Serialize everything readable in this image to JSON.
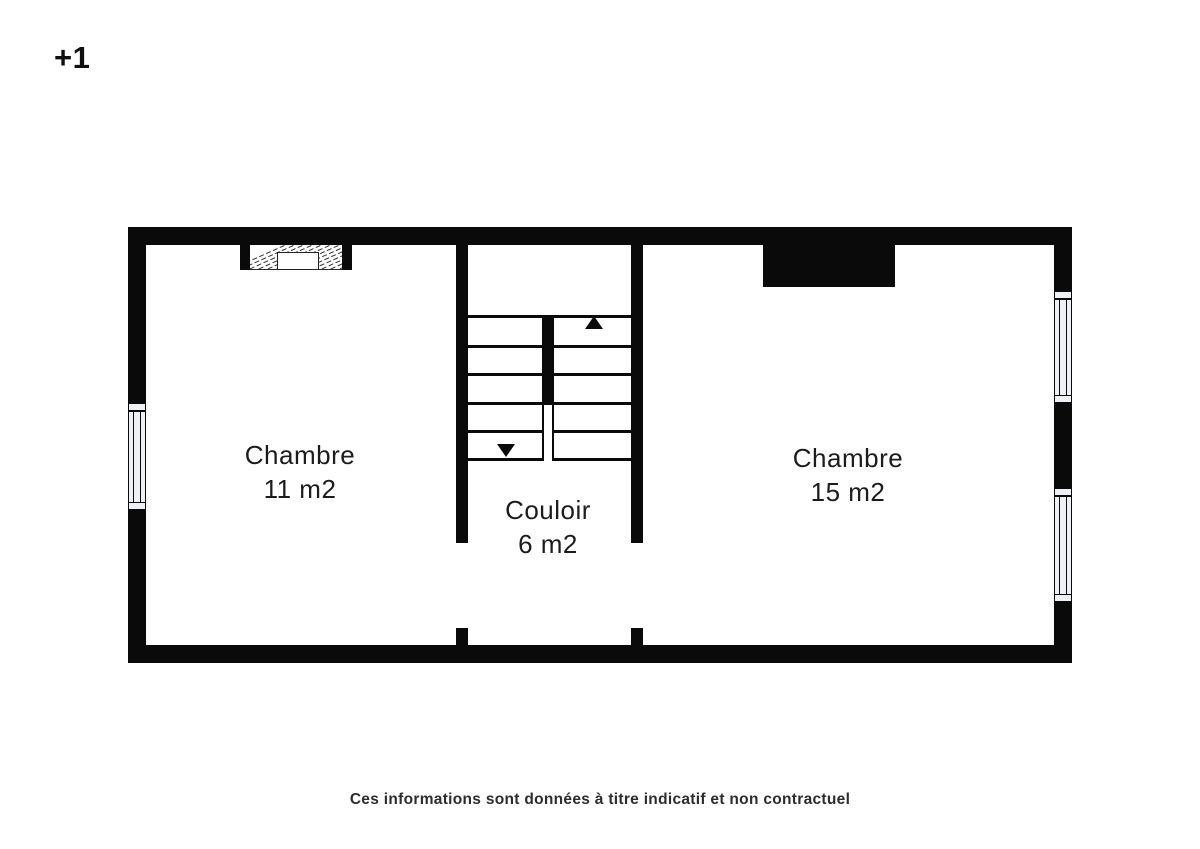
{
  "floor_label": "+1",
  "plan": {
    "rooms": [
      {
        "name": "Chambre",
        "area": "11 m2"
      },
      {
        "name": "Couloir",
        "area": "6 m2"
      },
      {
        "name": "Chambre",
        "area": "15 m2"
      }
    ],
    "stairs": {
      "up_icon": "triangle-up",
      "down_icon": "triangle-down"
    },
    "features": [
      "fireplace-hatched",
      "chimney-block",
      "window-left",
      "window-right-upper",
      "window-right-lower"
    ]
  },
  "disclaimer": "Ces informations sont données à titre indicatif et non contractuel",
  "colors": {
    "wall": "#0a0a0a",
    "window_fill": "#eef0f6",
    "text": "#1c1c1c",
    "background": "#ffffff"
  }
}
